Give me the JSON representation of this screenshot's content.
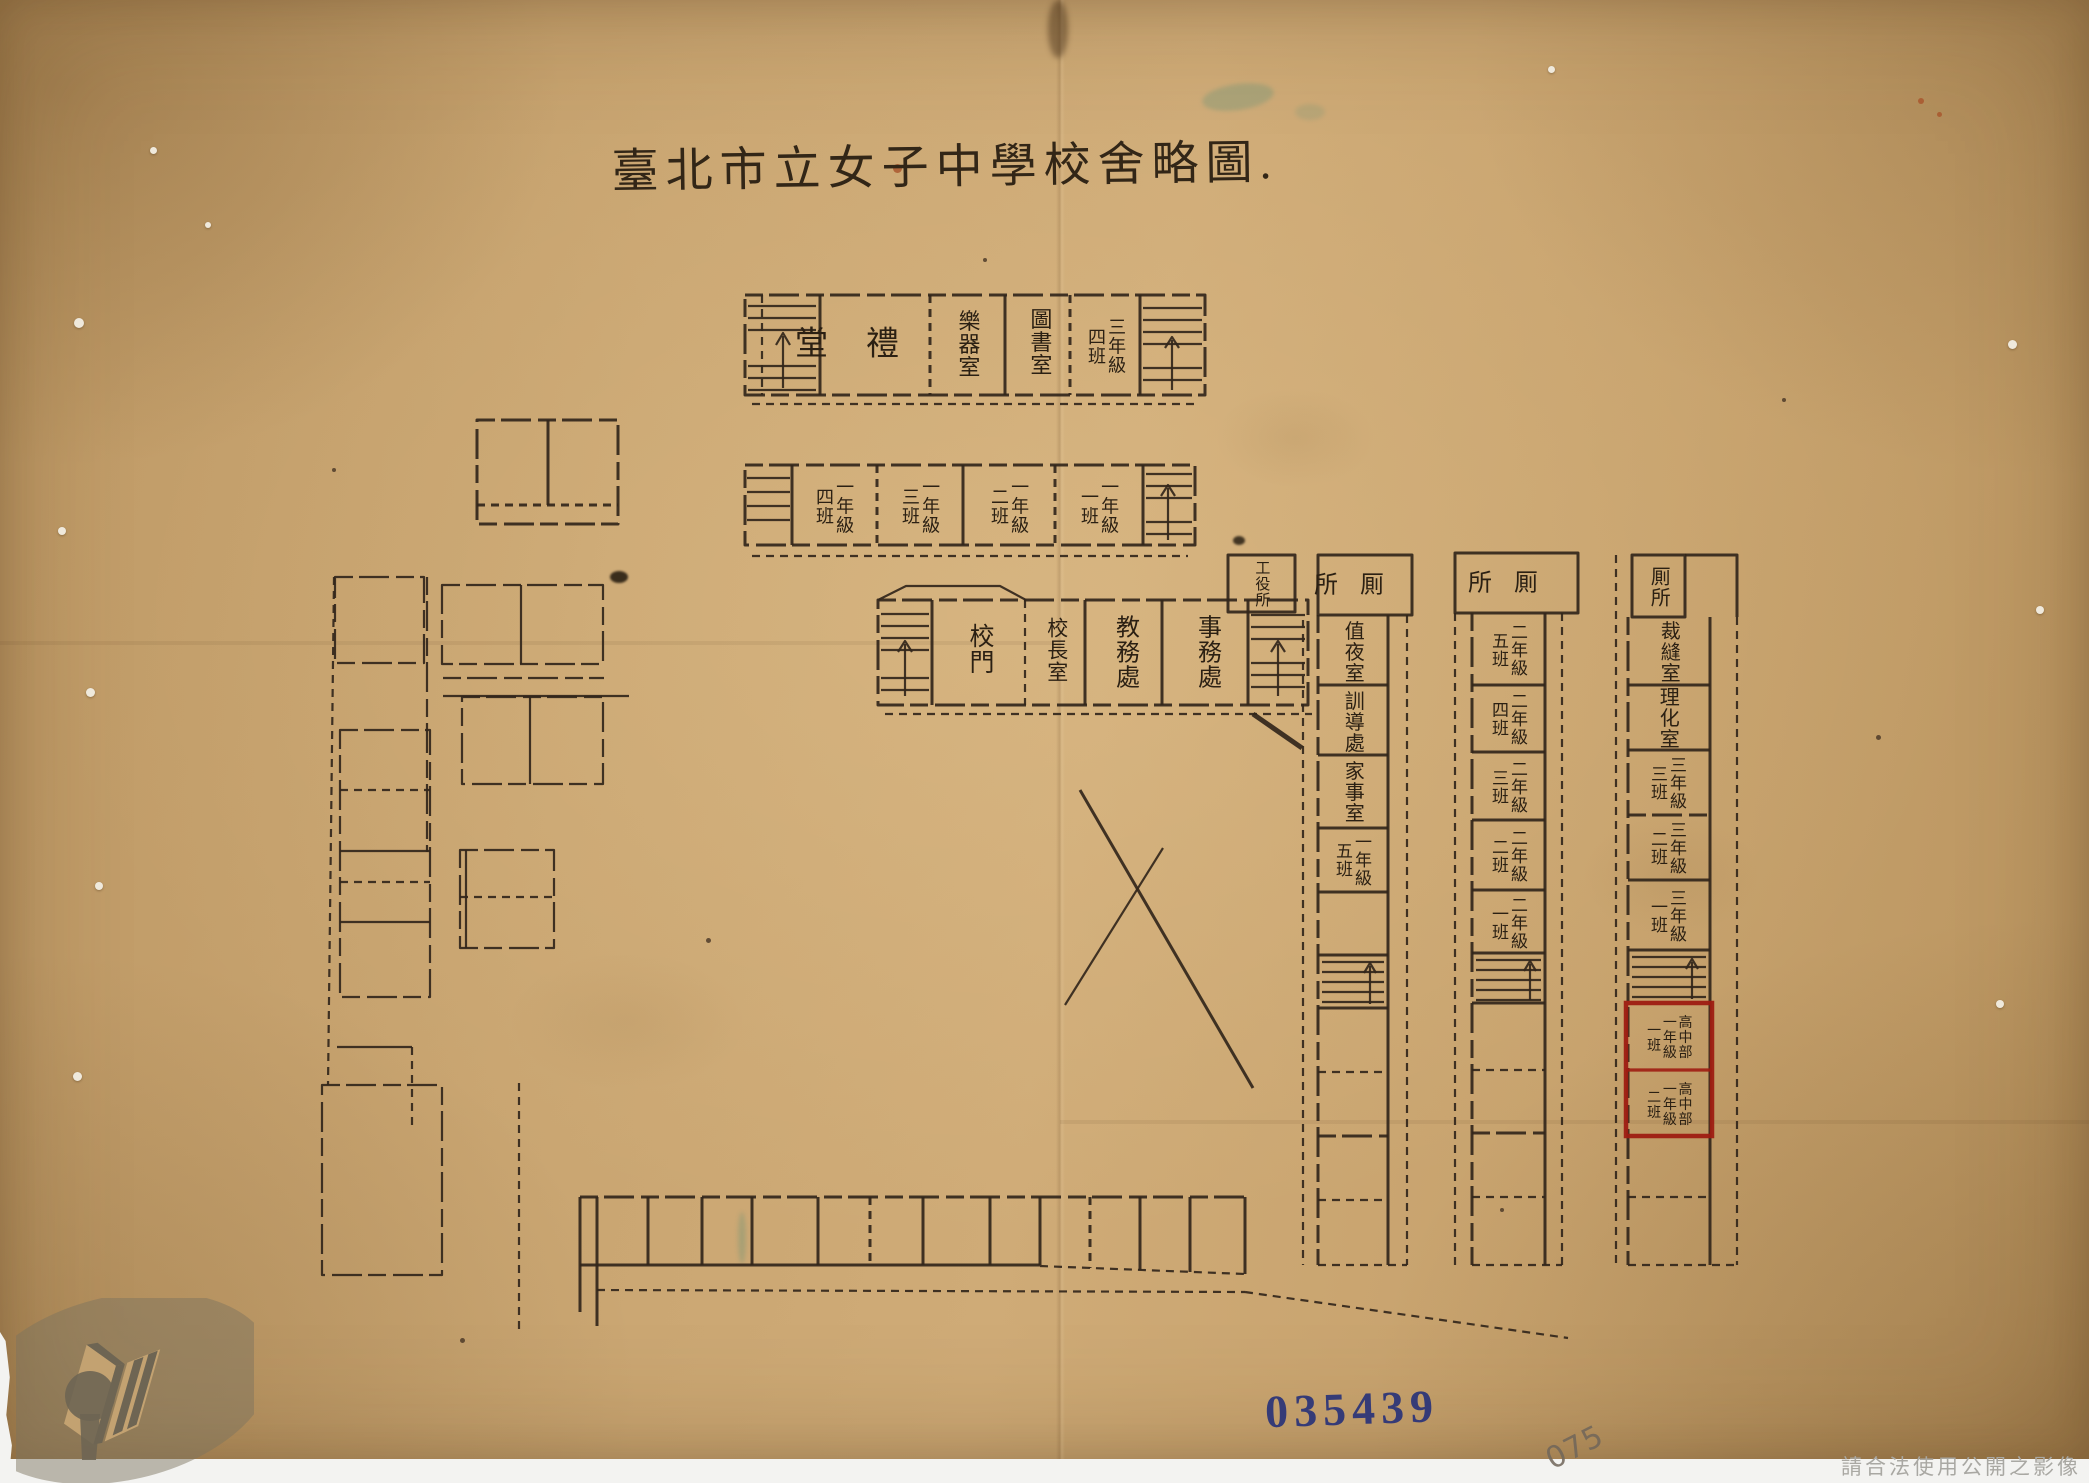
{
  "page": {
    "title": "臺北市立女子中學校舍略圖.",
    "stamp_number": "035439",
    "pencil_note": "075",
    "watermark_notice": "請合法使用公開之影像"
  },
  "colors": {
    "paper": "#c9a571",
    "ink": "#32261b",
    "highlight_red": "#9e1c12",
    "stamp_blue": "#2a3379",
    "pencil": "#70665a",
    "watermark_grey": "#a9a8a3"
  },
  "icons": {
    "stairs": "hatched-steps-with-up-arrow",
    "archives_logo": "open-book-with-keyhole"
  },
  "buildings": {
    "north_block": {
      "rooms": [
        {
          "label": "堂禮"
        },
        {
          "label": "樂器室"
        },
        {
          "label": "圖書室"
        },
        {
          "label": "三年級\n四班"
        }
      ]
    },
    "grade1_block": {
      "rooms": [
        {
          "label": "一年級\n四班"
        },
        {
          "label": "一年級\n三班"
        },
        {
          "label": "一年級\n二班"
        },
        {
          "label": "一年級\n一班"
        }
      ]
    },
    "admin_block": {
      "rooms": [
        {
          "label": "校門"
        },
        {
          "label": "校長室"
        },
        {
          "label": "教務處"
        },
        {
          "label": "事務處"
        }
      ]
    },
    "caretaker_room": {
      "label": "工役所"
    },
    "east_wing_inner": {
      "rooms": [
        {
          "label": "所厠"
        },
        {
          "label": "值夜室"
        },
        {
          "label": "訓導處"
        },
        {
          "label": "家事室"
        },
        {
          "label": "一年級\n五班"
        }
      ]
    },
    "east_wing_middle": {
      "rooms": [
        {
          "label": "所厠"
        },
        {
          "label": "二年級\n五班"
        },
        {
          "label": "二年級\n四班"
        },
        {
          "label": "二年級\n三班"
        },
        {
          "label": "二年級\n二班"
        },
        {
          "label": "二年級\n一班"
        }
      ]
    },
    "east_wing_outer": {
      "rooms": [
        {
          "label": "厠所"
        },
        {
          "label": "裁縫室"
        },
        {
          "label": "理化室"
        },
        {
          "label": "三年級\n三班"
        },
        {
          "label": "三年級\n二班"
        },
        {
          "label": "三年級\n一班"
        }
      ],
      "highlighted_rooms": [
        {
          "label": "高中部\n一年級\n一班"
        },
        {
          "label": "高中部\n一年級\n二班"
        }
      ]
    }
  }
}
